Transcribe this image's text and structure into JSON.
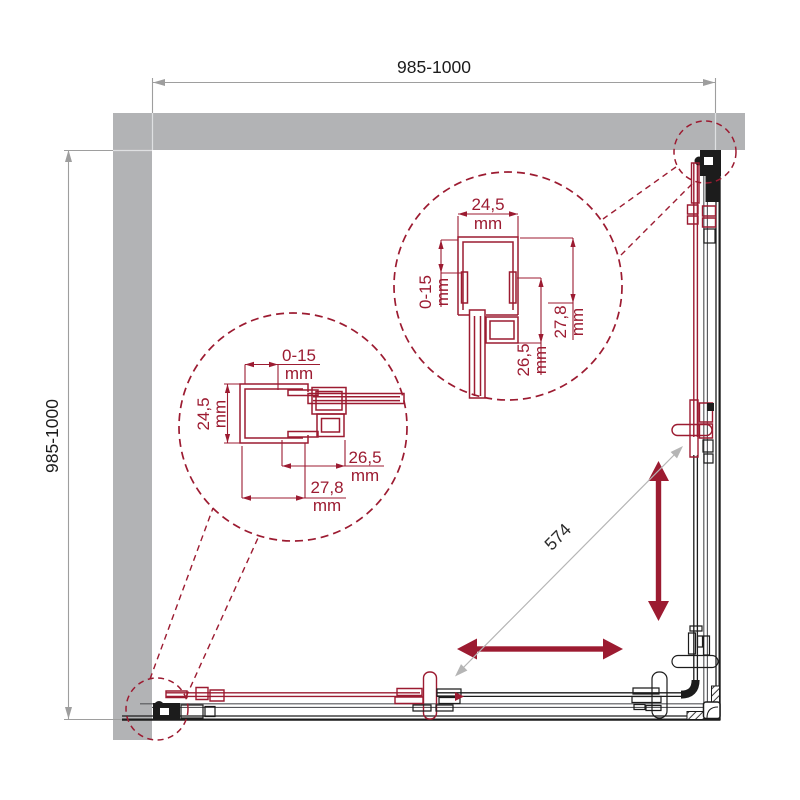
{
  "dimensions": {
    "width": {
      "label": "985-1000"
    },
    "depth": {
      "label": "985-1000"
    },
    "diagonal": {
      "label": "574"
    }
  },
  "detail_right": {
    "profile_width": {
      "value": "24,5",
      "unit": "mm"
    },
    "adjustment": {
      "value": "0-15",
      "unit": "mm"
    },
    "glass_inset": {
      "value": "26,5",
      "unit": "mm"
    },
    "profile_depth": {
      "value": "27,8",
      "unit": "mm"
    }
  },
  "detail_left": {
    "adjustment": {
      "value": "0-15",
      "unit": "mm"
    },
    "profile_width": {
      "value": "24,5",
      "unit": "mm"
    },
    "glass_inset": {
      "value": "26,5",
      "unit": "mm"
    },
    "profile_depth": {
      "value": "27,8",
      "unit": "mm"
    }
  },
  "colors": {
    "accent": "#9C1B31",
    "wall": "#B2B3B5",
    "line": "#1C1C1C",
    "dim": "#9E9E9E"
  }
}
